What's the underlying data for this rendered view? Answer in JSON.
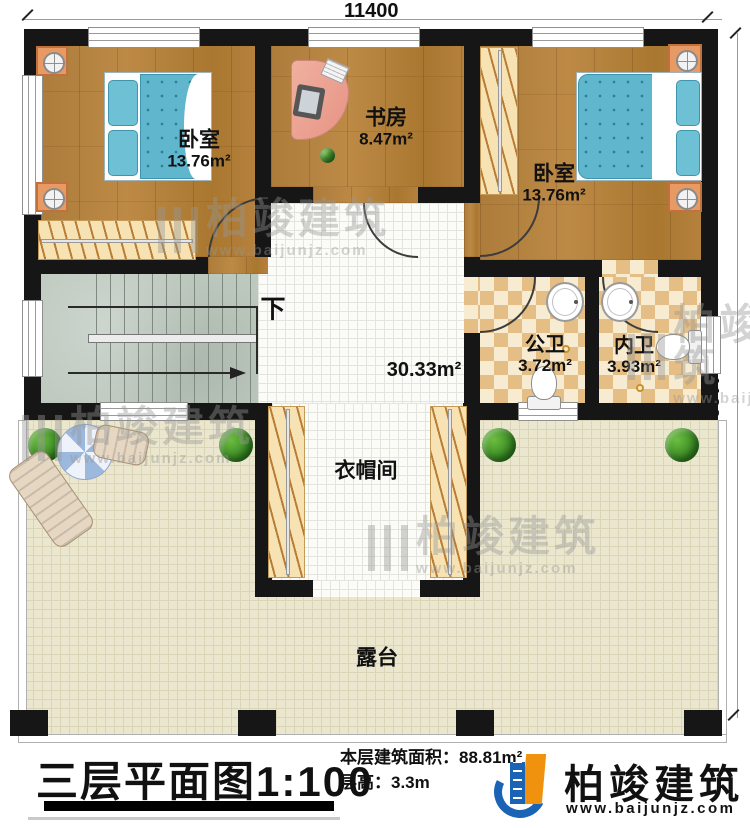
{
  "dimensions": {
    "top": "11400",
    "right": "11600"
  },
  "rooms": {
    "bedroom_left": {
      "name": "卧室",
      "area": "13.76m²"
    },
    "study": {
      "name": "书房",
      "area": "8.47m²"
    },
    "bedroom_right": {
      "name": "卧室",
      "area": "13.76m²"
    },
    "stair": {
      "down_label": "下"
    },
    "hall": {
      "area": "30.33m²"
    },
    "public_bath": {
      "name": "公卫",
      "area": "3.72m²"
    },
    "ensuite_bath": {
      "name": "内卫",
      "area": "3.93m²"
    },
    "cloakroom": {
      "name": "衣帽间"
    },
    "terrace": {
      "name": "露台"
    }
  },
  "footer": {
    "plan_title": "三层平面图",
    "plan_scale": "1:100",
    "floor_area_label": "本层建筑面积：",
    "floor_area_value": "88.81m²",
    "floor_height_label": "层高：",
    "floor_height_value": "3.3m"
  },
  "brand": {
    "name": "柏竣建筑",
    "website": "www.baijunjz.com"
  },
  "watermark": {
    "name": "柏竣建筑",
    "website": "www.baijunjz.com"
  },
  "colors": {
    "wall": "#161616",
    "bed": "#5fb6cd",
    "tile_dark": "#e5be85",
    "terrace": "#ebe7cf",
    "brand_blue": "#1a63b5",
    "brand_orange": "#f0920e"
  }
}
